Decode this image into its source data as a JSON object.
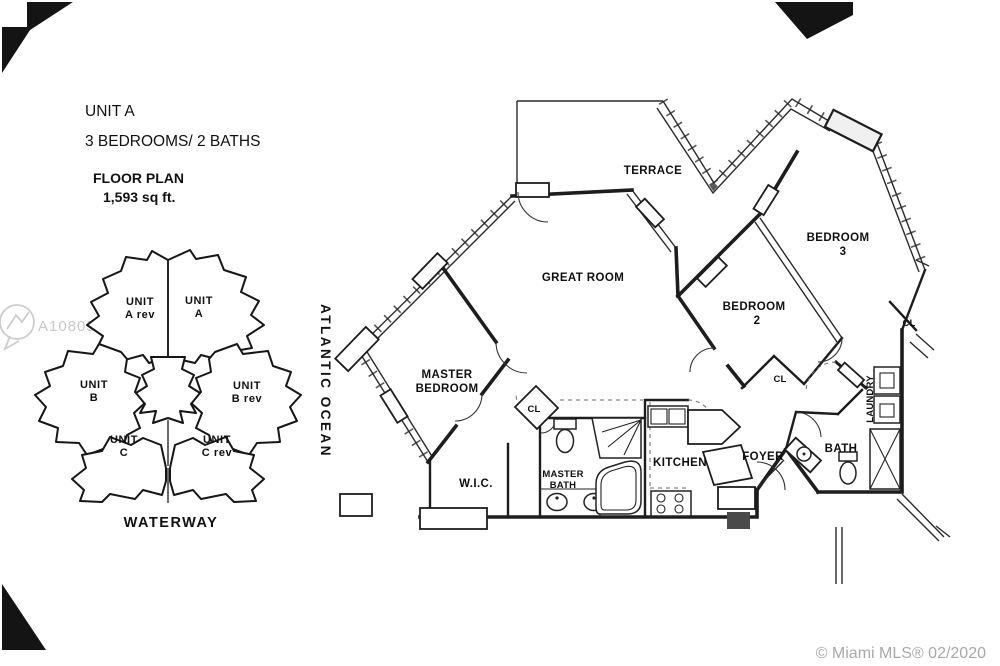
{
  "title_block": {
    "unit": "UNIT A",
    "specs": "3 BEDROOMS/ 2  BATHS",
    "plan_label": "FLOOR PLAN",
    "area": "1,593 sq ft."
  },
  "key_plan": {
    "waterway_label": "WATERWAY",
    "highlight_color": "#f3a7a5",
    "units": [
      {
        "name": "UNIT",
        "variant": "A rev",
        "highlighted": false
      },
      {
        "name": "UNIT",
        "variant": "A",
        "highlighted": true
      },
      {
        "name": "UNIT",
        "variant": "B",
        "highlighted": false
      },
      {
        "name": "UNIT",
        "variant": "B rev",
        "highlighted": false
      },
      {
        "name": "UNIT",
        "variant": "C",
        "highlighted": false
      },
      {
        "name": "UNIT",
        "variant": "C rev",
        "highlighted": false
      }
    ]
  },
  "orientation": {
    "ocean_label": "ATLANTIC OCEAN"
  },
  "floor_plan": {
    "rooms": {
      "terrace": "TERRACE",
      "great_room": "GREAT ROOM",
      "master_bedroom_1": "MASTER",
      "master_bedroom_2": "BEDROOM",
      "bedroom2_1": "BEDROOM",
      "bedroom2_2": "2",
      "bedroom3_1": "BEDROOM",
      "bedroom3_2": "3",
      "wic": "W.I.C.",
      "master_bath_1": "MASTER",
      "master_bath_2": "BATH",
      "kitchen": "KITCHEN",
      "foyer": "FOYER",
      "bath": "BATH",
      "laundry": "LAUNDRY",
      "closet": "CL"
    }
  },
  "watermarks": {
    "mls_number": "A10805142",
    "credit": "© Miami MLS® 02/2020"
  }
}
